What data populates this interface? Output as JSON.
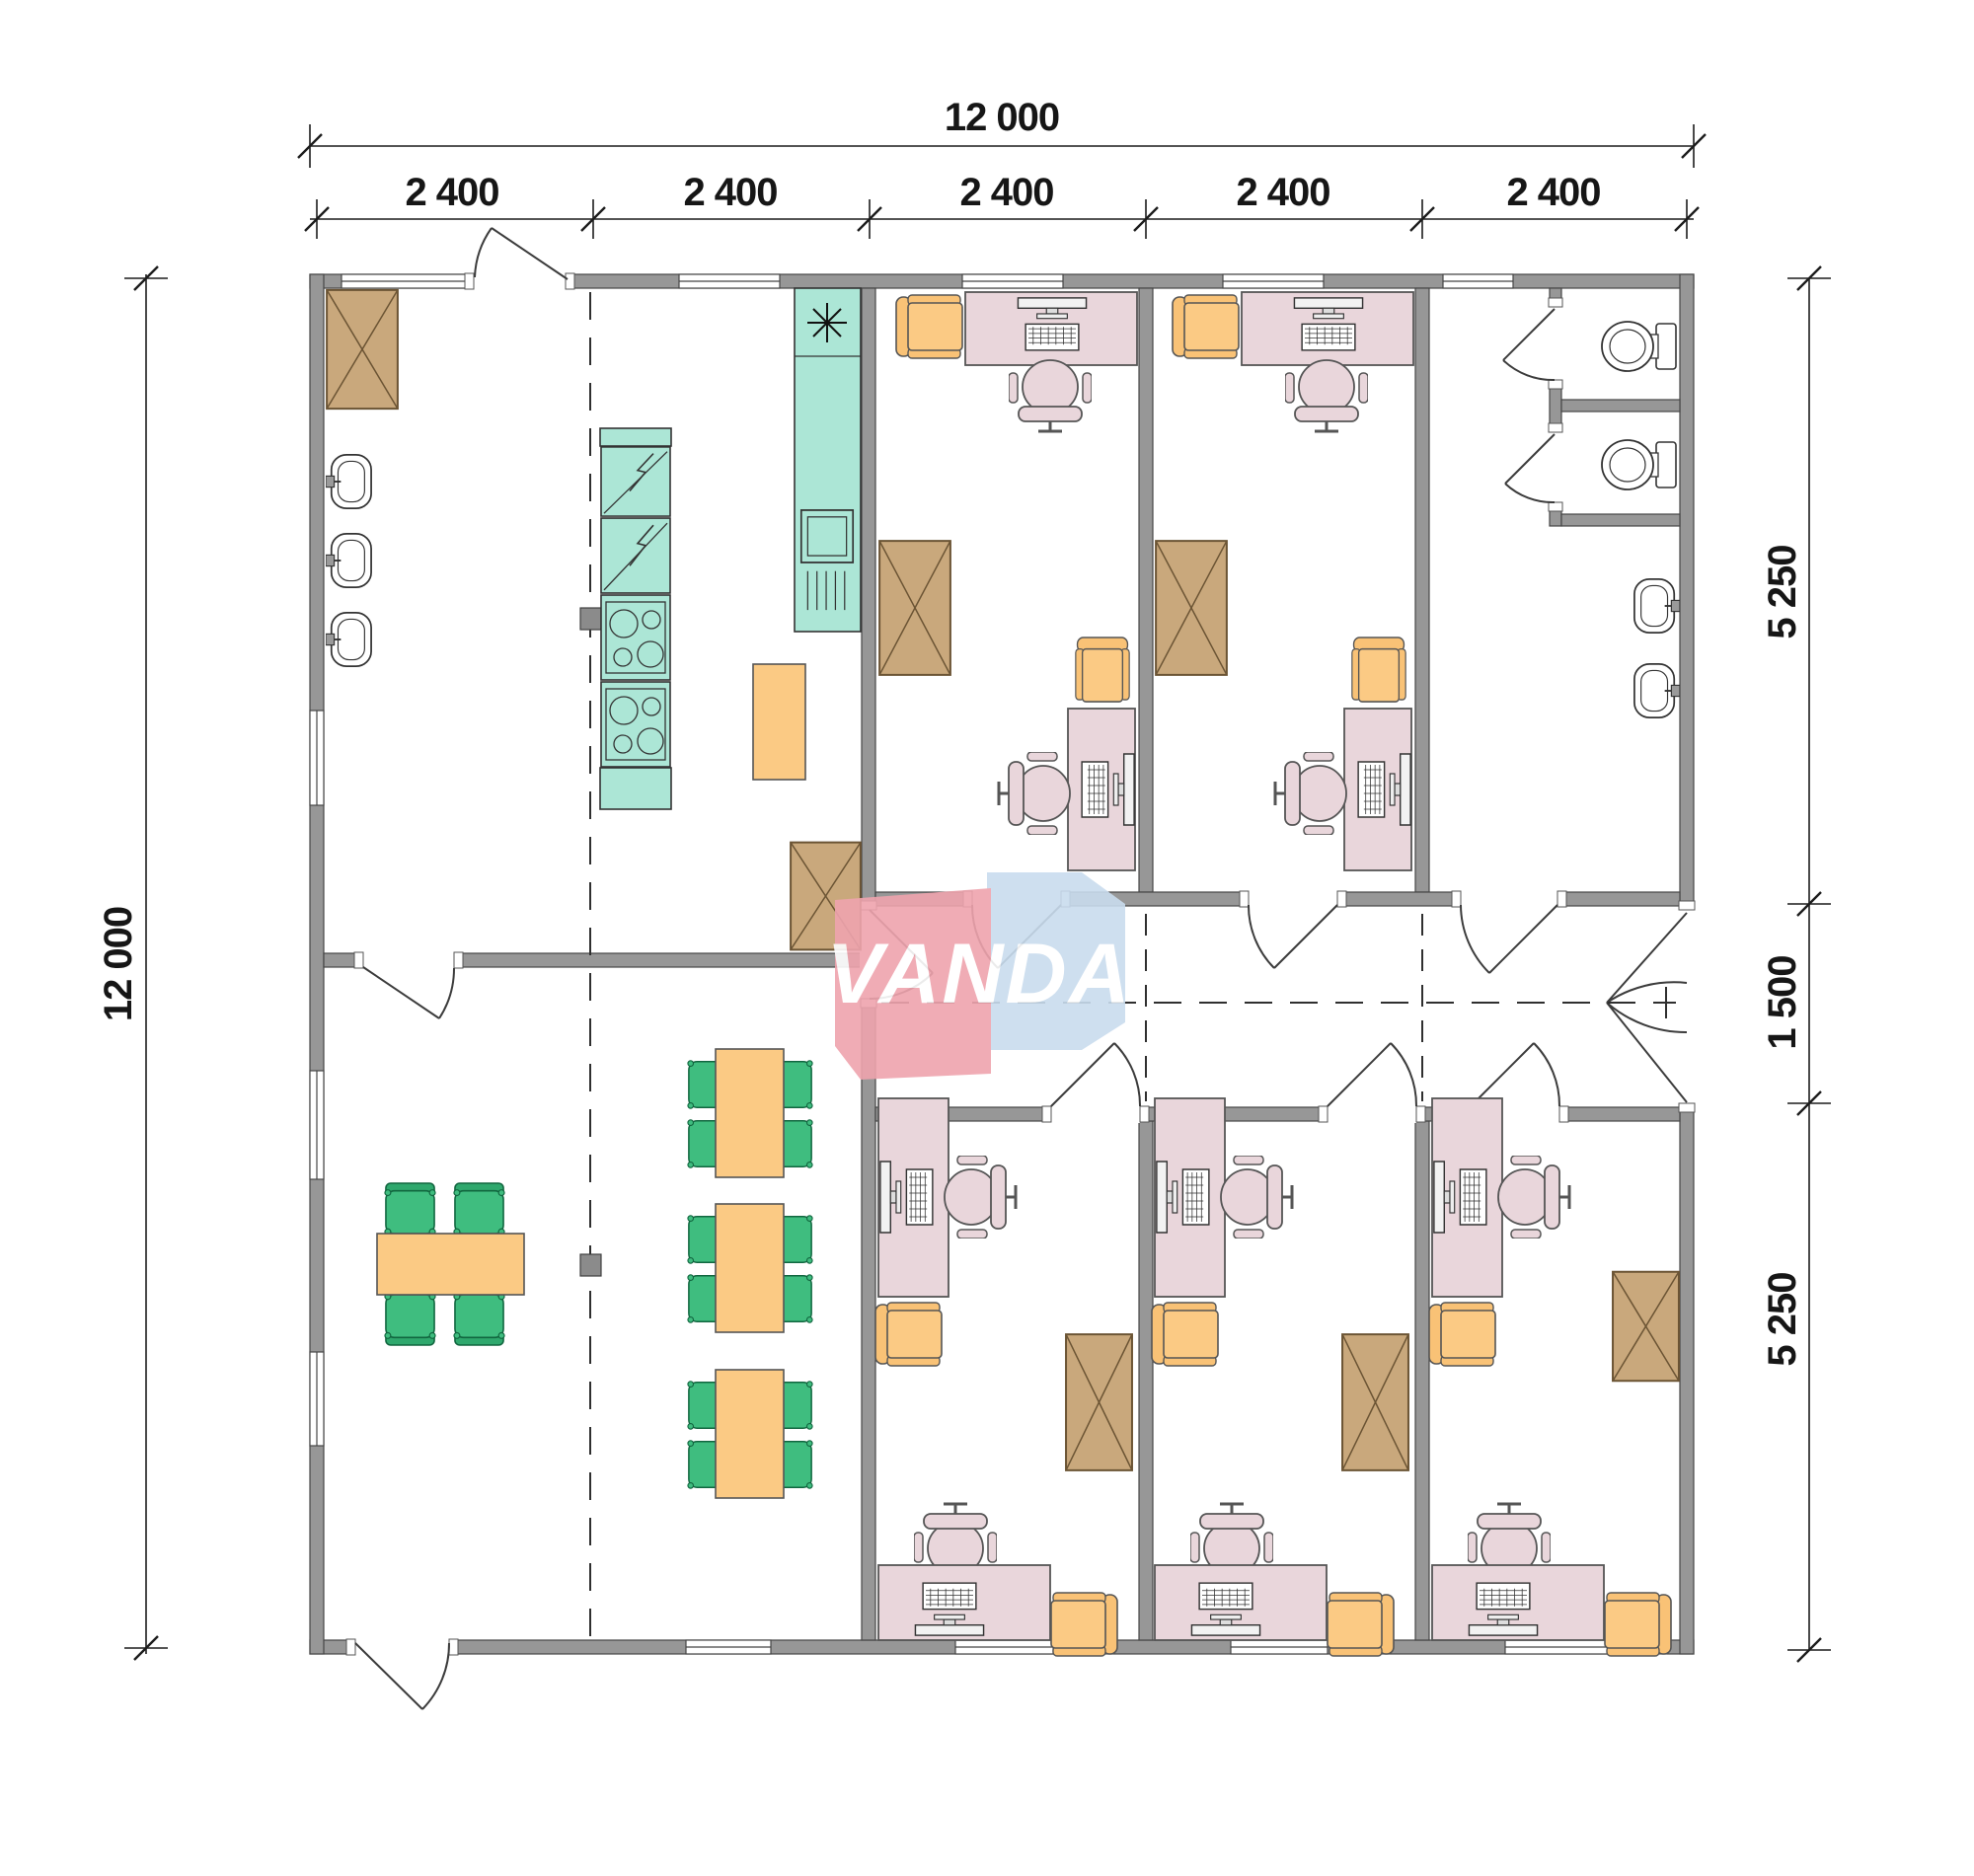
{
  "drawing": {
    "brand": {
      "name": "VANDA"
    },
    "dimensions": {
      "top_total": "12 000",
      "top_modules": [
        "2 400",
        "2 400",
        "2 400",
        "2 400",
        "2 400"
      ],
      "left_total": "12 000",
      "right_segments": [
        "5 250",
        "1 500",
        "5 250"
      ]
    },
    "colors": {
      "wall": "#979797",
      "wardrobe": "#C9A87C",
      "desk": "#E9D6DB",
      "office_chair": "#E9D6DB",
      "guest_chair": "#FBCA84",
      "dining_chair": "#3FBD7F",
      "dining_table": "#FBCA84",
      "kitchen_unit": "#ACE6D6",
      "logo_red": "#EFA4AE",
      "logo_blue": "#C9DCEE"
    }
  }
}
